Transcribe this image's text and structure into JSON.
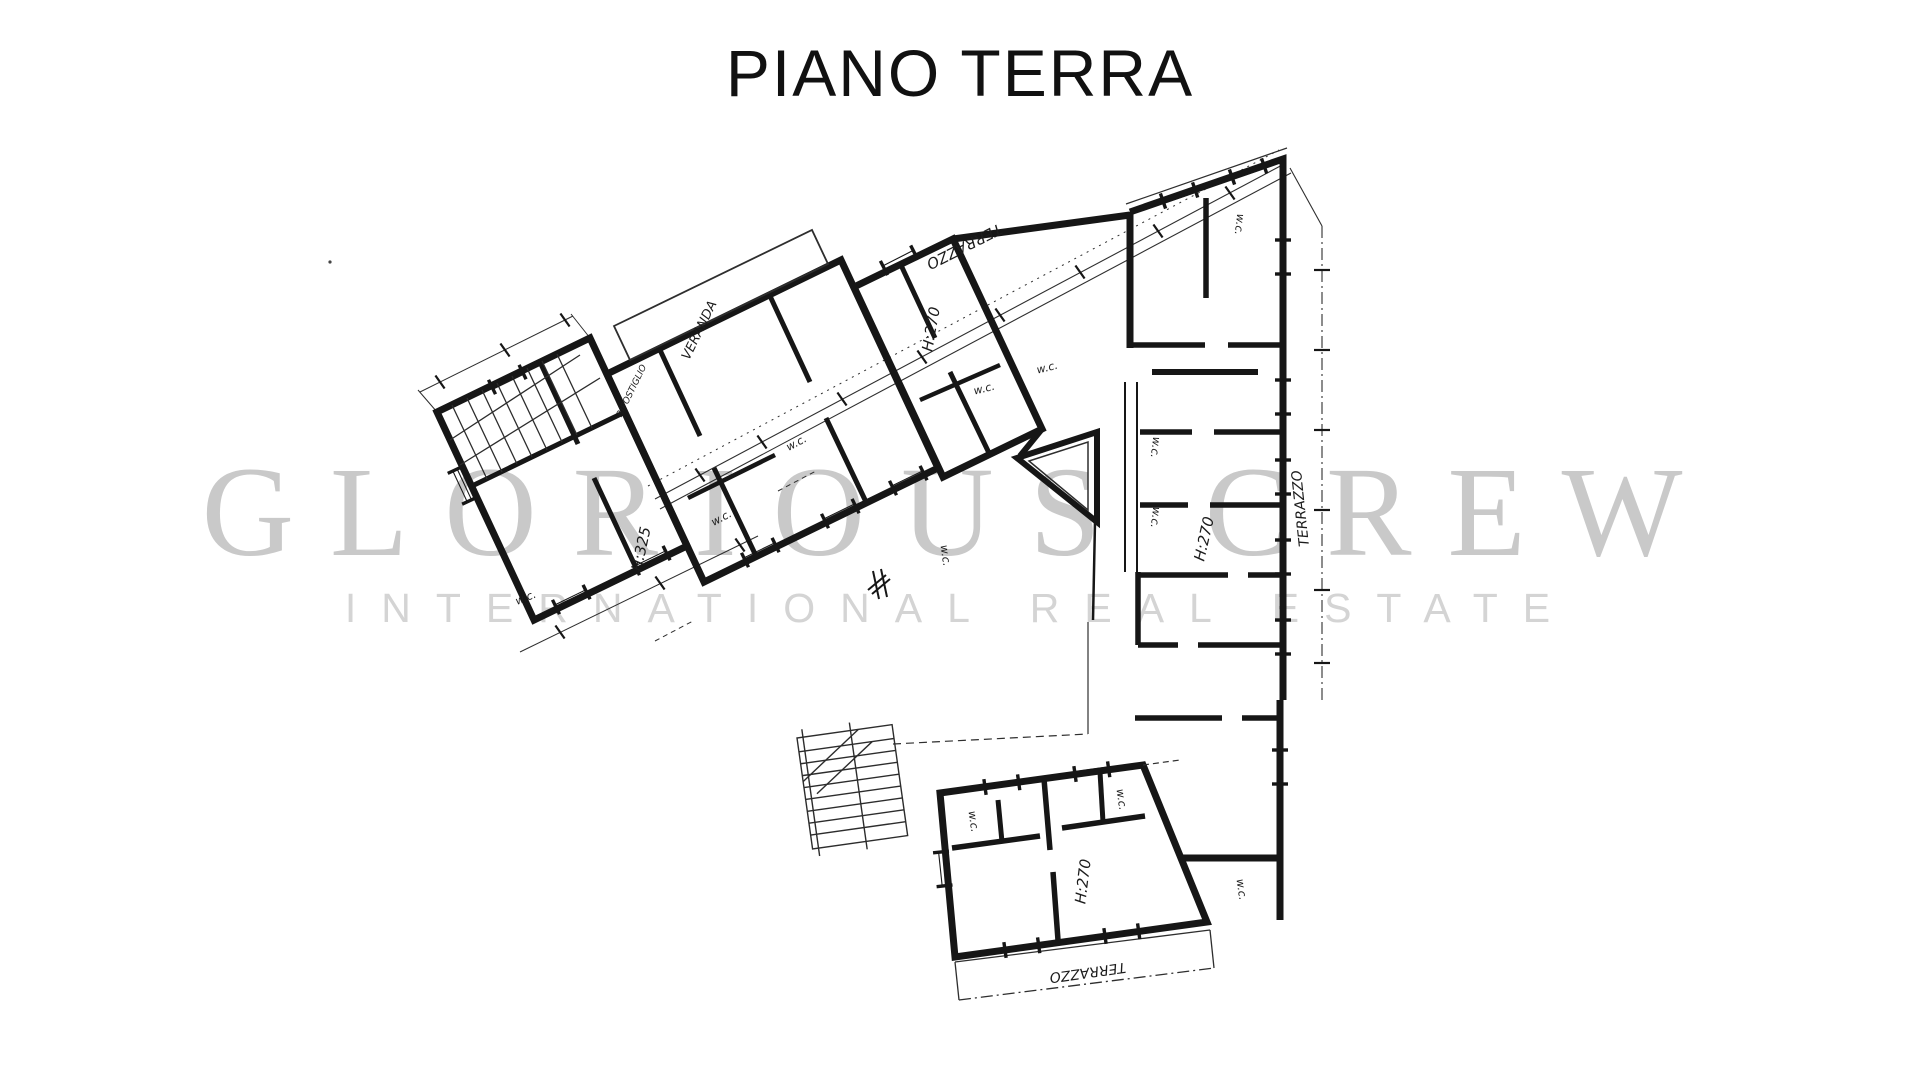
{
  "title": "PIANO TERRA",
  "watermark": {
    "line1": "GLORIOUS CREW",
    "line2": "INTERNATIONAL REAL ESTATE"
  },
  "plan": {
    "labels": {
      "terrazzo_top": "TERRAZZO",
      "terrazzo_right": "TERRAZZO",
      "terrazzo_bottom": "TERRAZZO",
      "veranda": "VERANDA",
      "ripostiglio": "RIPOSTIGLIO",
      "h325": "H:325",
      "h270_top": "H:270",
      "h270_right": "H:270",
      "h270_bottom": "H:270",
      "wc": "w.c."
    },
    "colors": {
      "ink": "#161616",
      "watermark_primary": "#c9c9c9",
      "watermark_secondary": "#d4d4d4"
    }
  }
}
